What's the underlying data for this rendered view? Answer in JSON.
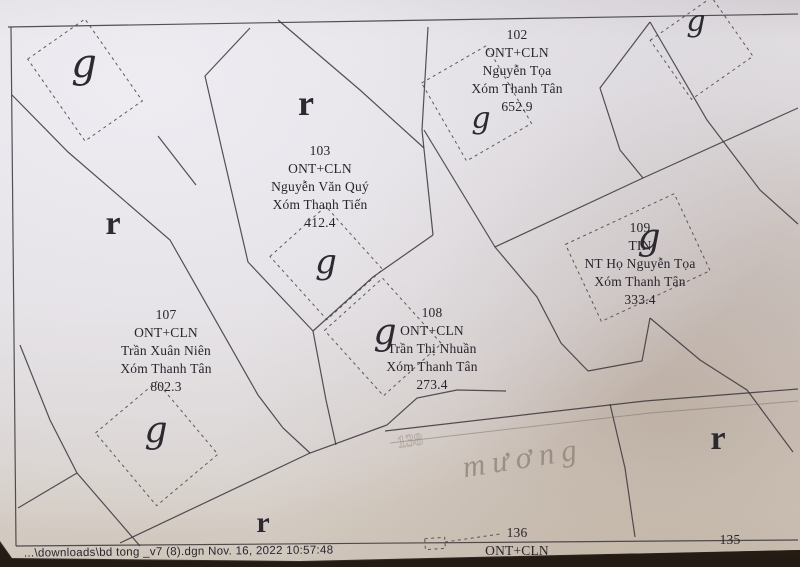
{
  "window": {
    "footer": "...\\downloads\\bd tong _v7 (8).dgn  Nov. 16, 2022  10:57:48"
  },
  "map": {
    "parcels": [
      {
        "id": "102",
        "land_use": "ONT+CLN",
        "owner": "Nguyễn Tọa",
        "hamlet": "Xóm Thanh Tân",
        "area": "652.9"
      },
      {
        "id": "103",
        "land_use": "ONT+CLN",
        "owner": "Nguyễn Văn Quý",
        "hamlet": "Xóm Thanh Tiến",
        "area": "412.4"
      },
      {
        "id": "107",
        "land_use": "ONT+CLN",
        "owner": "Trần Xuân Niên",
        "hamlet": "Xóm Thanh Tân",
        "area": "802.3"
      },
      {
        "id": "108",
        "land_use": "ONT+CLN",
        "owner": "Trần Thị Nhuần",
        "hamlet": "Xóm Thanh Tân",
        "area": "273.4"
      },
      {
        "id": "109",
        "land_use": "TIN",
        "owner": "NT Họ Nguyễn Tọa",
        "hamlet": "Xóm Thanh Tân",
        "area": "333.4"
      },
      {
        "id": "136",
        "land_use": "ONT+CLN"
      },
      {
        "id": "135"
      }
    ],
    "canal_label": "mương",
    "faint_parcel_number": "138",
    "symbols": {
      "g": "g",
      "r": "r"
    }
  },
  "colors": {
    "paper": "#e2dfe2",
    "ink": "#26262c",
    "boundary_line": "#3c3a40",
    "canal_text": "#8d8478",
    "photo_edge": "#2b231b"
  }
}
